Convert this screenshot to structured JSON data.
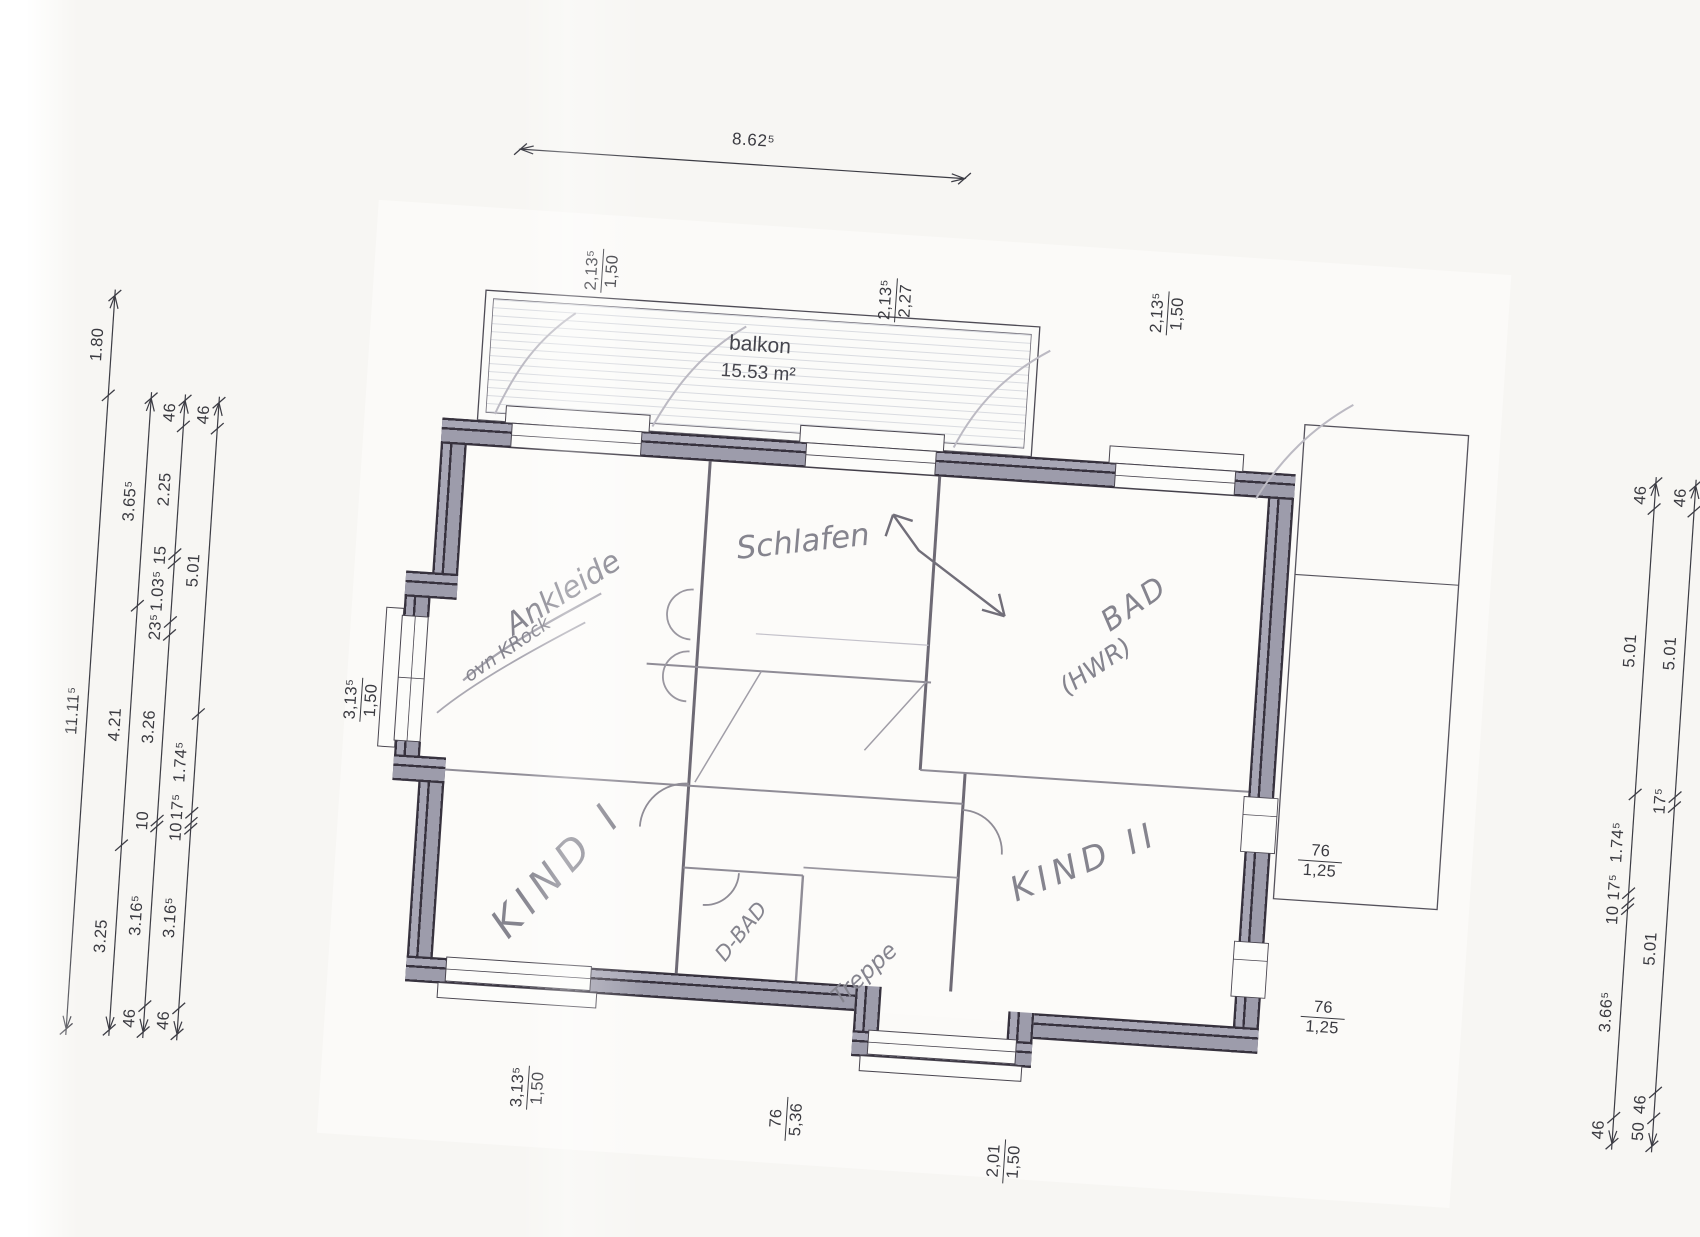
{
  "plan": {
    "balcony": {
      "name": "balkon",
      "area": "15.53 m²"
    },
    "rooms": {
      "ankleide": "Ankleide",
      "ankleide_note": "ovn KRock",
      "schlafen": "Schlafen",
      "bad_line1": "BAD",
      "bad_line2": "(HWR)",
      "kind1": "KIND I",
      "kind2": "KIND II",
      "dbad": "D-BAD",
      "treppe": "Treppe"
    }
  },
  "dimensions": {
    "top_overall": "8.62⁵",
    "left_chains": [
      {
        "labels": [
          "1.80",
          "11.11⁵"
        ]
      },
      {
        "labels": [
          "3.65⁵",
          "4.21",
          "3.25"
        ]
      },
      {
        "labels": [
          "46",
          "2.25",
          "15",
          "1.03⁵",
          "23⁵",
          "3.26",
          "10",
          "3.16⁵",
          "46"
        ]
      },
      {
        "labels": [
          "46",
          "5.01",
          "1.74⁵",
          "17⁵",
          "10",
          "3.16⁵",
          "46"
        ]
      }
    ],
    "right_chains": [
      {
        "labels": [
          "46",
          "5.01",
          "1.74⁵",
          "17⁵",
          "10",
          "3.66⁵",
          "46"
        ]
      },
      {
        "labels": [
          "46",
          "5.01",
          "17⁵",
          "5.01",
          "46",
          "50"
        ]
      }
    ],
    "fractions": [
      {
        "num": "2,13⁵",
        "den": "1,50"
      },
      {
        "num": "2,13⁵",
        "den": "2,27"
      },
      {
        "num": "2,13⁵",
        "den": "1,50"
      },
      {
        "num": "3,13⁵",
        "den": "1,50"
      },
      {
        "num": "3,13⁵",
        "den": "1,50"
      },
      {
        "num": "76",
        "den": "5,36"
      },
      {
        "num": "2,01",
        "den": "1,50"
      },
      {
        "num": "76",
        "den": "1,25"
      },
      {
        "num": "76",
        "den": "1,25"
      }
    ]
  },
  "colors": {
    "wall_fill": "#a3a2b2",
    "wall_line": "#37323e",
    "pencil": "#85848e",
    "dim_text": "#3a3a40",
    "paper": "#f7f6f3"
  }
}
